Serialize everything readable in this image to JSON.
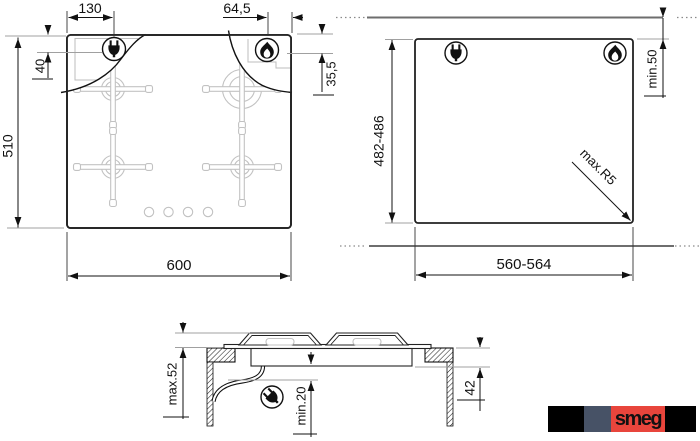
{
  "top_view": {
    "plug_offset_x": "130",
    "gas_offset_x": "64,5",
    "plug_offset_y": "40",
    "gas_offset_y": "35,5",
    "total_depth": "510",
    "total_width": "600"
  },
  "cutout_view": {
    "cutout_depth": "482-486",
    "rear_clearance": "min.50",
    "corner_radius": "max.R5",
    "cutout_width": "560-564"
  },
  "side_view": {
    "height_above": "max.52",
    "clearance_below": "min.20",
    "recess_depth": "42"
  },
  "icons": {
    "plug": "power-plug",
    "flame": "gas-flame"
  },
  "logo": {
    "text": "smeg",
    "colors": {
      "background": "#000000",
      "slate": "#475266",
      "red": "#e8453c",
      "letter": "#c0392b"
    }
  }
}
